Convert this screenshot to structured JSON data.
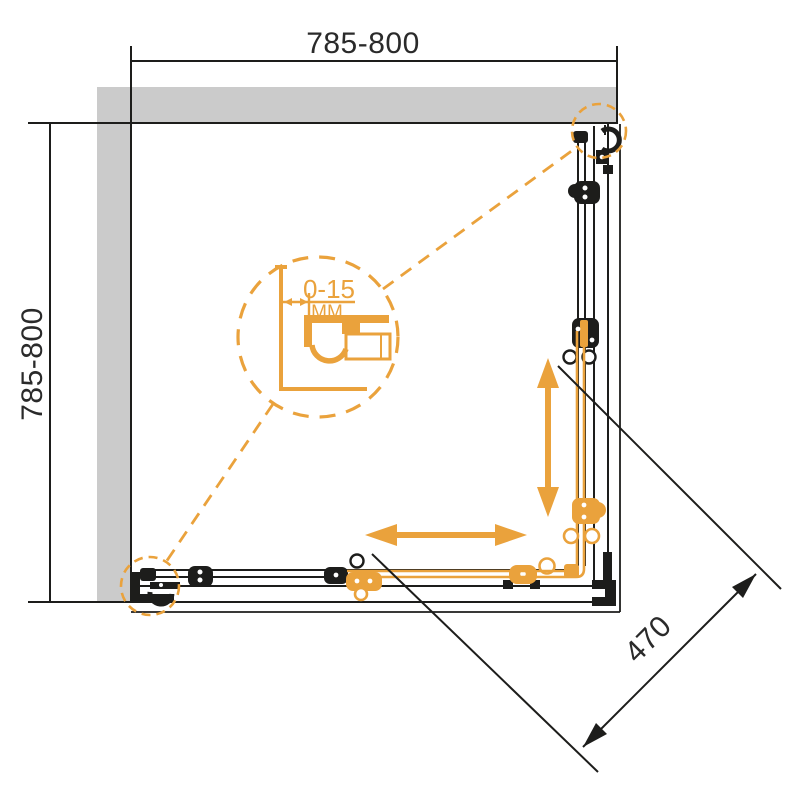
{
  "drawing": {
    "type": "shower-enclosure-corner-entry-plan",
    "dimensions": {
      "width_top": "785-800",
      "depth_left": "785-800",
      "diagonal_entry": "470",
      "wall_profile_adjustment": "0-15",
      "unit_label": "MM"
    },
    "colors": {
      "accent_orange": "#EAA23C",
      "wall_gray": "#CBCBCB",
      "line_black": "#1D1D1B",
      "background": "#FFFFFF"
    },
    "icons": {
      "vertical_slide_arrow": "double-headed-arrow-vertical",
      "horizontal_slide_arrow": "double-headed-arrow-horizontal",
      "detail_callout": "dashed-circle-magnifier"
    }
  }
}
